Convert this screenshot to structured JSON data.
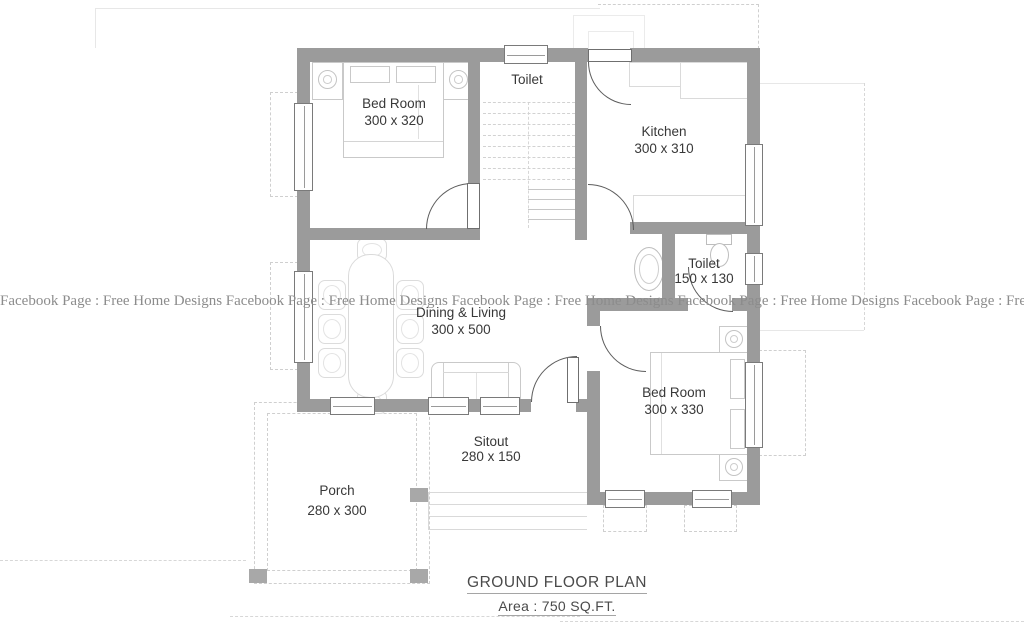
{
  "watermark": {
    "text": "Facebook Page : Free Home Designs  Facebook Page : Free Home Designs Facebook Page : Free Home Designs Facebook Page : Free Home Designs Facebook Page : Free Home DesignsFa"
  },
  "title": {
    "plan": "GROUND FLOOR PLAN",
    "area": "Area : 750 SQ.FT."
  },
  "rooms": [
    {
      "id": "bedroom-1",
      "name": "Bed Room",
      "size": "300 x 320"
    },
    {
      "id": "toilet-1",
      "name": "Toilet",
      "size": ""
    },
    {
      "id": "kitchen",
      "name": "Kitchen",
      "size": "300 x 310"
    },
    {
      "id": "toilet-2",
      "name": "Toilet",
      "size": "150 x 130"
    },
    {
      "id": "dining-living",
      "name": "Dining & Living",
      "size": "300 x 500"
    },
    {
      "id": "bedroom-2",
      "name": "Bed Room",
      "size": "300 x 330"
    },
    {
      "id": "sitout",
      "name": "Sitout",
      "size": "280 x 150"
    },
    {
      "id": "porch",
      "name": "Porch",
      "size": "280 x 300"
    }
  ],
  "fixtures": [
    "double-bed",
    "nightstand",
    "dining-table",
    "chair",
    "sofa",
    "kitchen-counter",
    "staircase",
    "wash-basin",
    "toilet-wc",
    "window",
    "door-swing",
    "porch-pillar"
  ],
  "colors": {
    "wall": "#9b9b9b",
    "label_text": "#383838",
    "watermark_text": "#8c8c8c",
    "furniture_outline": "#c9c9c9",
    "door_arc": "#5c5c5c",
    "construction_line": "#d7d7d7"
  }
}
